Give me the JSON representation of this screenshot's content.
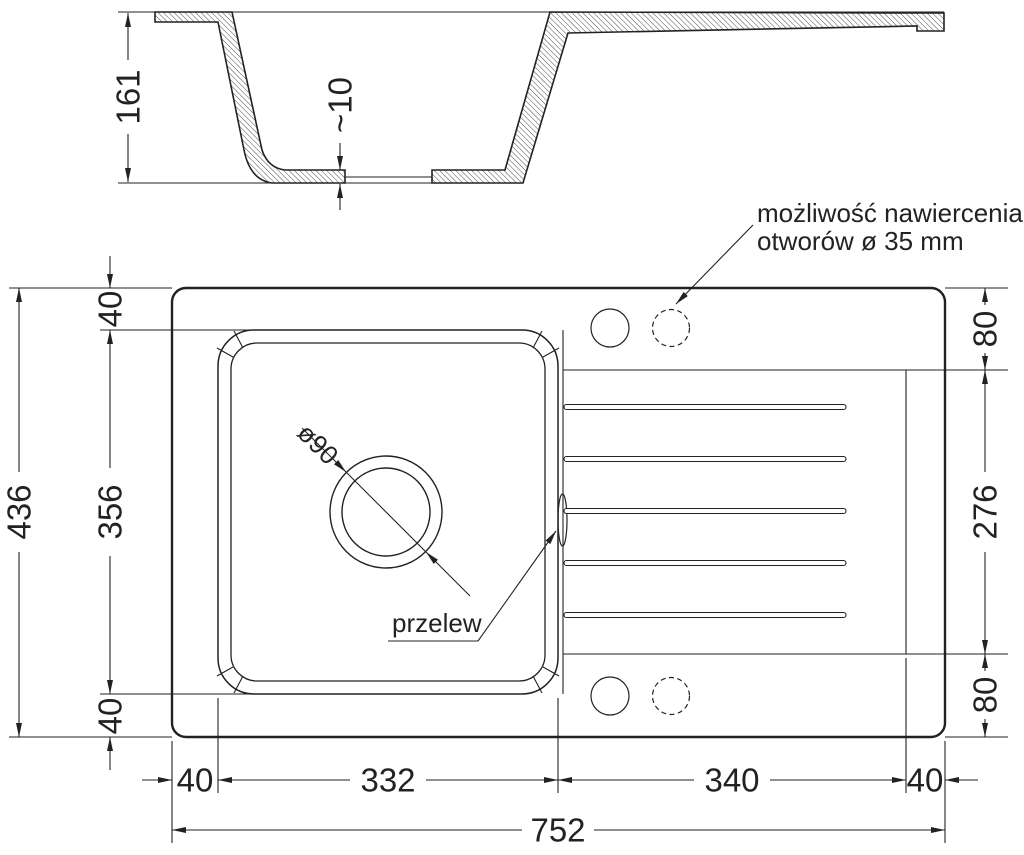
{
  "meta": {
    "background": "#ffffff",
    "line_color": "#222222",
    "drawing_type": "kitchen sink technical dimension drawing"
  },
  "section_view": {
    "depth_label": "161",
    "bottom_thickness_label": "~10"
  },
  "plan_view": {
    "drill_note": {
      "line1": "możliwość nawiercenia",
      "line2": "otworów ø 35 mm"
    },
    "overflow_label": "przelew",
    "drain_label": "ø90",
    "dims": {
      "overall_length": "752",
      "overall_width": "436",
      "left_top": "40",
      "left_middle": "356",
      "left_bottom": "40",
      "right_top": "80",
      "right_middle": "276",
      "right_bottom": "80",
      "bottom_left_edge": "40",
      "bottom_bowl": "332",
      "bottom_drainer": "340",
      "bottom_right_edge": "40"
    }
  }
}
